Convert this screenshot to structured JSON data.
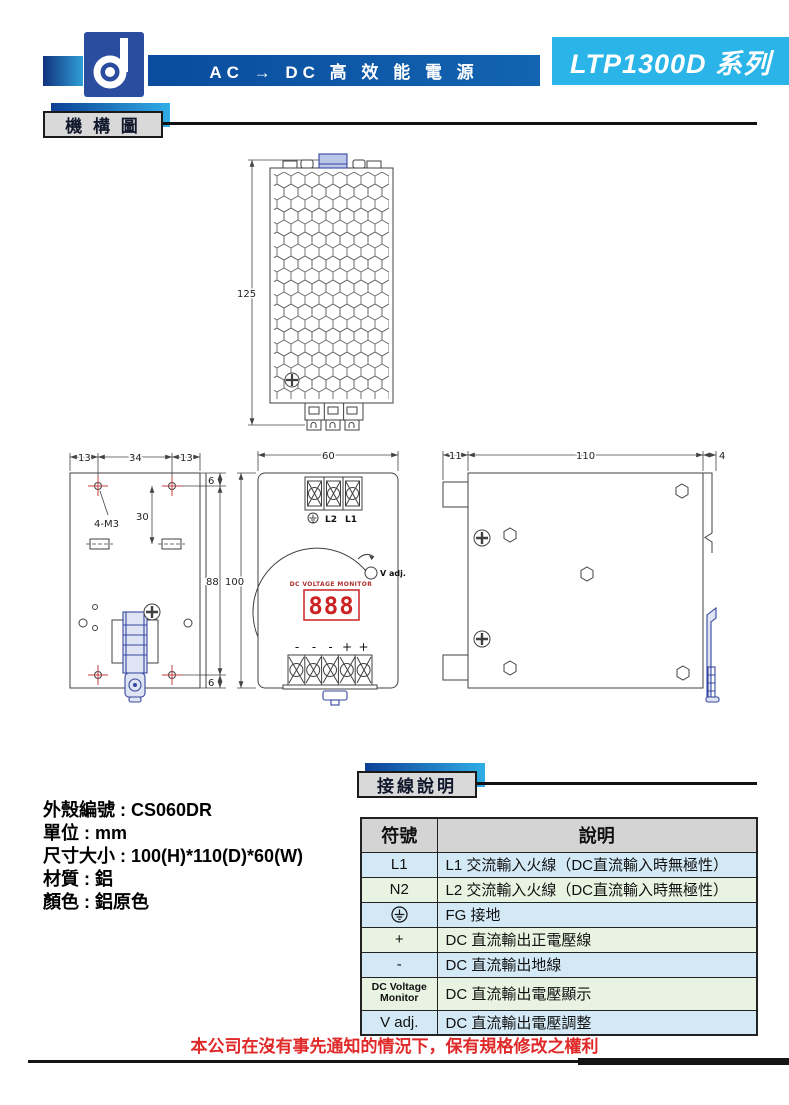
{
  "header": {
    "logo_icon": "d-monogram",
    "banner_text": "AC → DC 高 效 能 電 源",
    "series_label": "LTP1300D 系列"
  },
  "section_mechanical": {
    "title": "機 構 圖"
  },
  "section_wiring": {
    "title": "接線說明"
  },
  "drawing_top_view": {
    "dim_height": "125"
  },
  "drawing_rear_view": {
    "dim_left": "13",
    "dim_center": "34",
    "dim_right": "13",
    "dim_top_offset": "6",
    "dim_hole_spacing": "30",
    "dim_body_height": "88",
    "dim_bottom_offset": "6",
    "hole_label": "4-M3"
  },
  "drawing_front_view": {
    "dim_width": "60",
    "dim_height": "100",
    "terminal_l2": "L2",
    "terminal_l1": "L1",
    "ground_icon": "earth-ground",
    "vadj_label": "V adj.",
    "monitor_label": "DC VOLTAGE MONITOR",
    "display_value": "888",
    "polarity": [
      "-",
      "-",
      "-",
      "+",
      "+"
    ]
  },
  "drawing_side_view": {
    "dim_left": "11",
    "dim_center": "110",
    "dim_right": "4"
  },
  "specs": {
    "line1": "外殼編號 : CS060DR",
    "line2": "單位 : mm",
    "line3": "尺寸大小 : 100(H)*110(D)*60(W)",
    "line4": "材質 : 鋁",
    "line5": "顏色 : 鋁原色"
  },
  "wiring_table": {
    "col_symbol": "符號",
    "col_desc": "說明",
    "rows": [
      {
        "symbol": "L1",
        "desc": "L1 交流輸入火線（DC直流輸入時無極性）"
      },
      {
        "symbol": "N2",
        "desc": "L2 交流輸入火線（DC直流輸入時無極性）"
      },
      {
        "symbol": "⏚",
        "desc": "FG 接地"
      },
      {
        "symbol": "+",
        "desc": "DC 直流輸出正電壓線"
      },
      {
        "symbol": "-",
        "desc": "DC 直流輸出地線"
      },
      {
        "symbol": "DC Voltage Monitor",
        "desc": "DC 直流輸出電壓顯示"
      },
      {
        "symbol": "V adj.",
        "desc": "DC 直流輸出電壓調整"
      }
    ]
  },
  "footer": {
    "disclaimer": "本公司在沒有事先通知的情況下，保有規格修改之權利"
  }
}
